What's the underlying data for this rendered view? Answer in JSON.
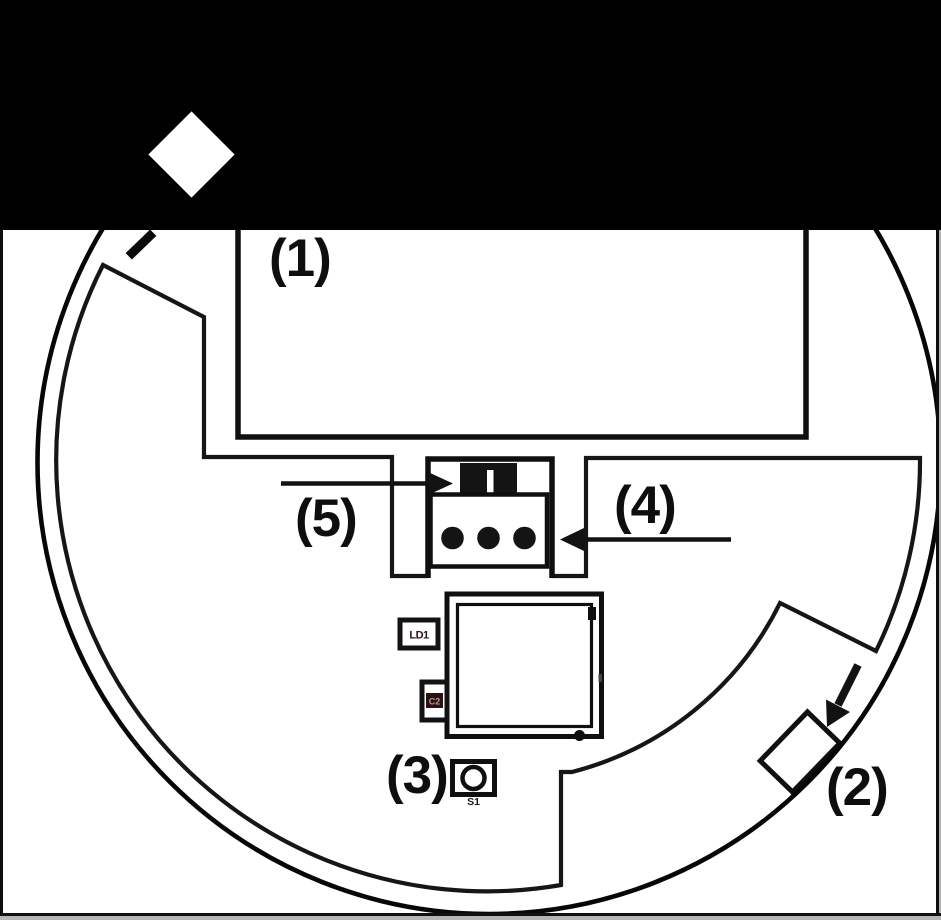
{
  "figure": {
    "callouts": [
      {
        "id": "1",
        "label": "(1)"
      },
      {
        "id": "2",
        "label": "(2)"
      },
      {
        "id": "3",
        "label": "(3)"
      },
      {
        "id": "4",
        "label": "(4)"
      },
      {
        "id": "5",
        "label": "(5)"
      }
    ],
    "component_labels": {
      "ld1": "LD1",
      "c2": "C2",
      "s1": "S1"
    },
    "colors": {
      "band": "#000000",
      "line": "#121212",
      "background": "#ffffff",
      "component_text": "#2a1212",
      "c2_badge": "#2b1212",
      "c2_text": "#c09090",
      "frame_grey": "#b5b5b5"
    }
  }
}
